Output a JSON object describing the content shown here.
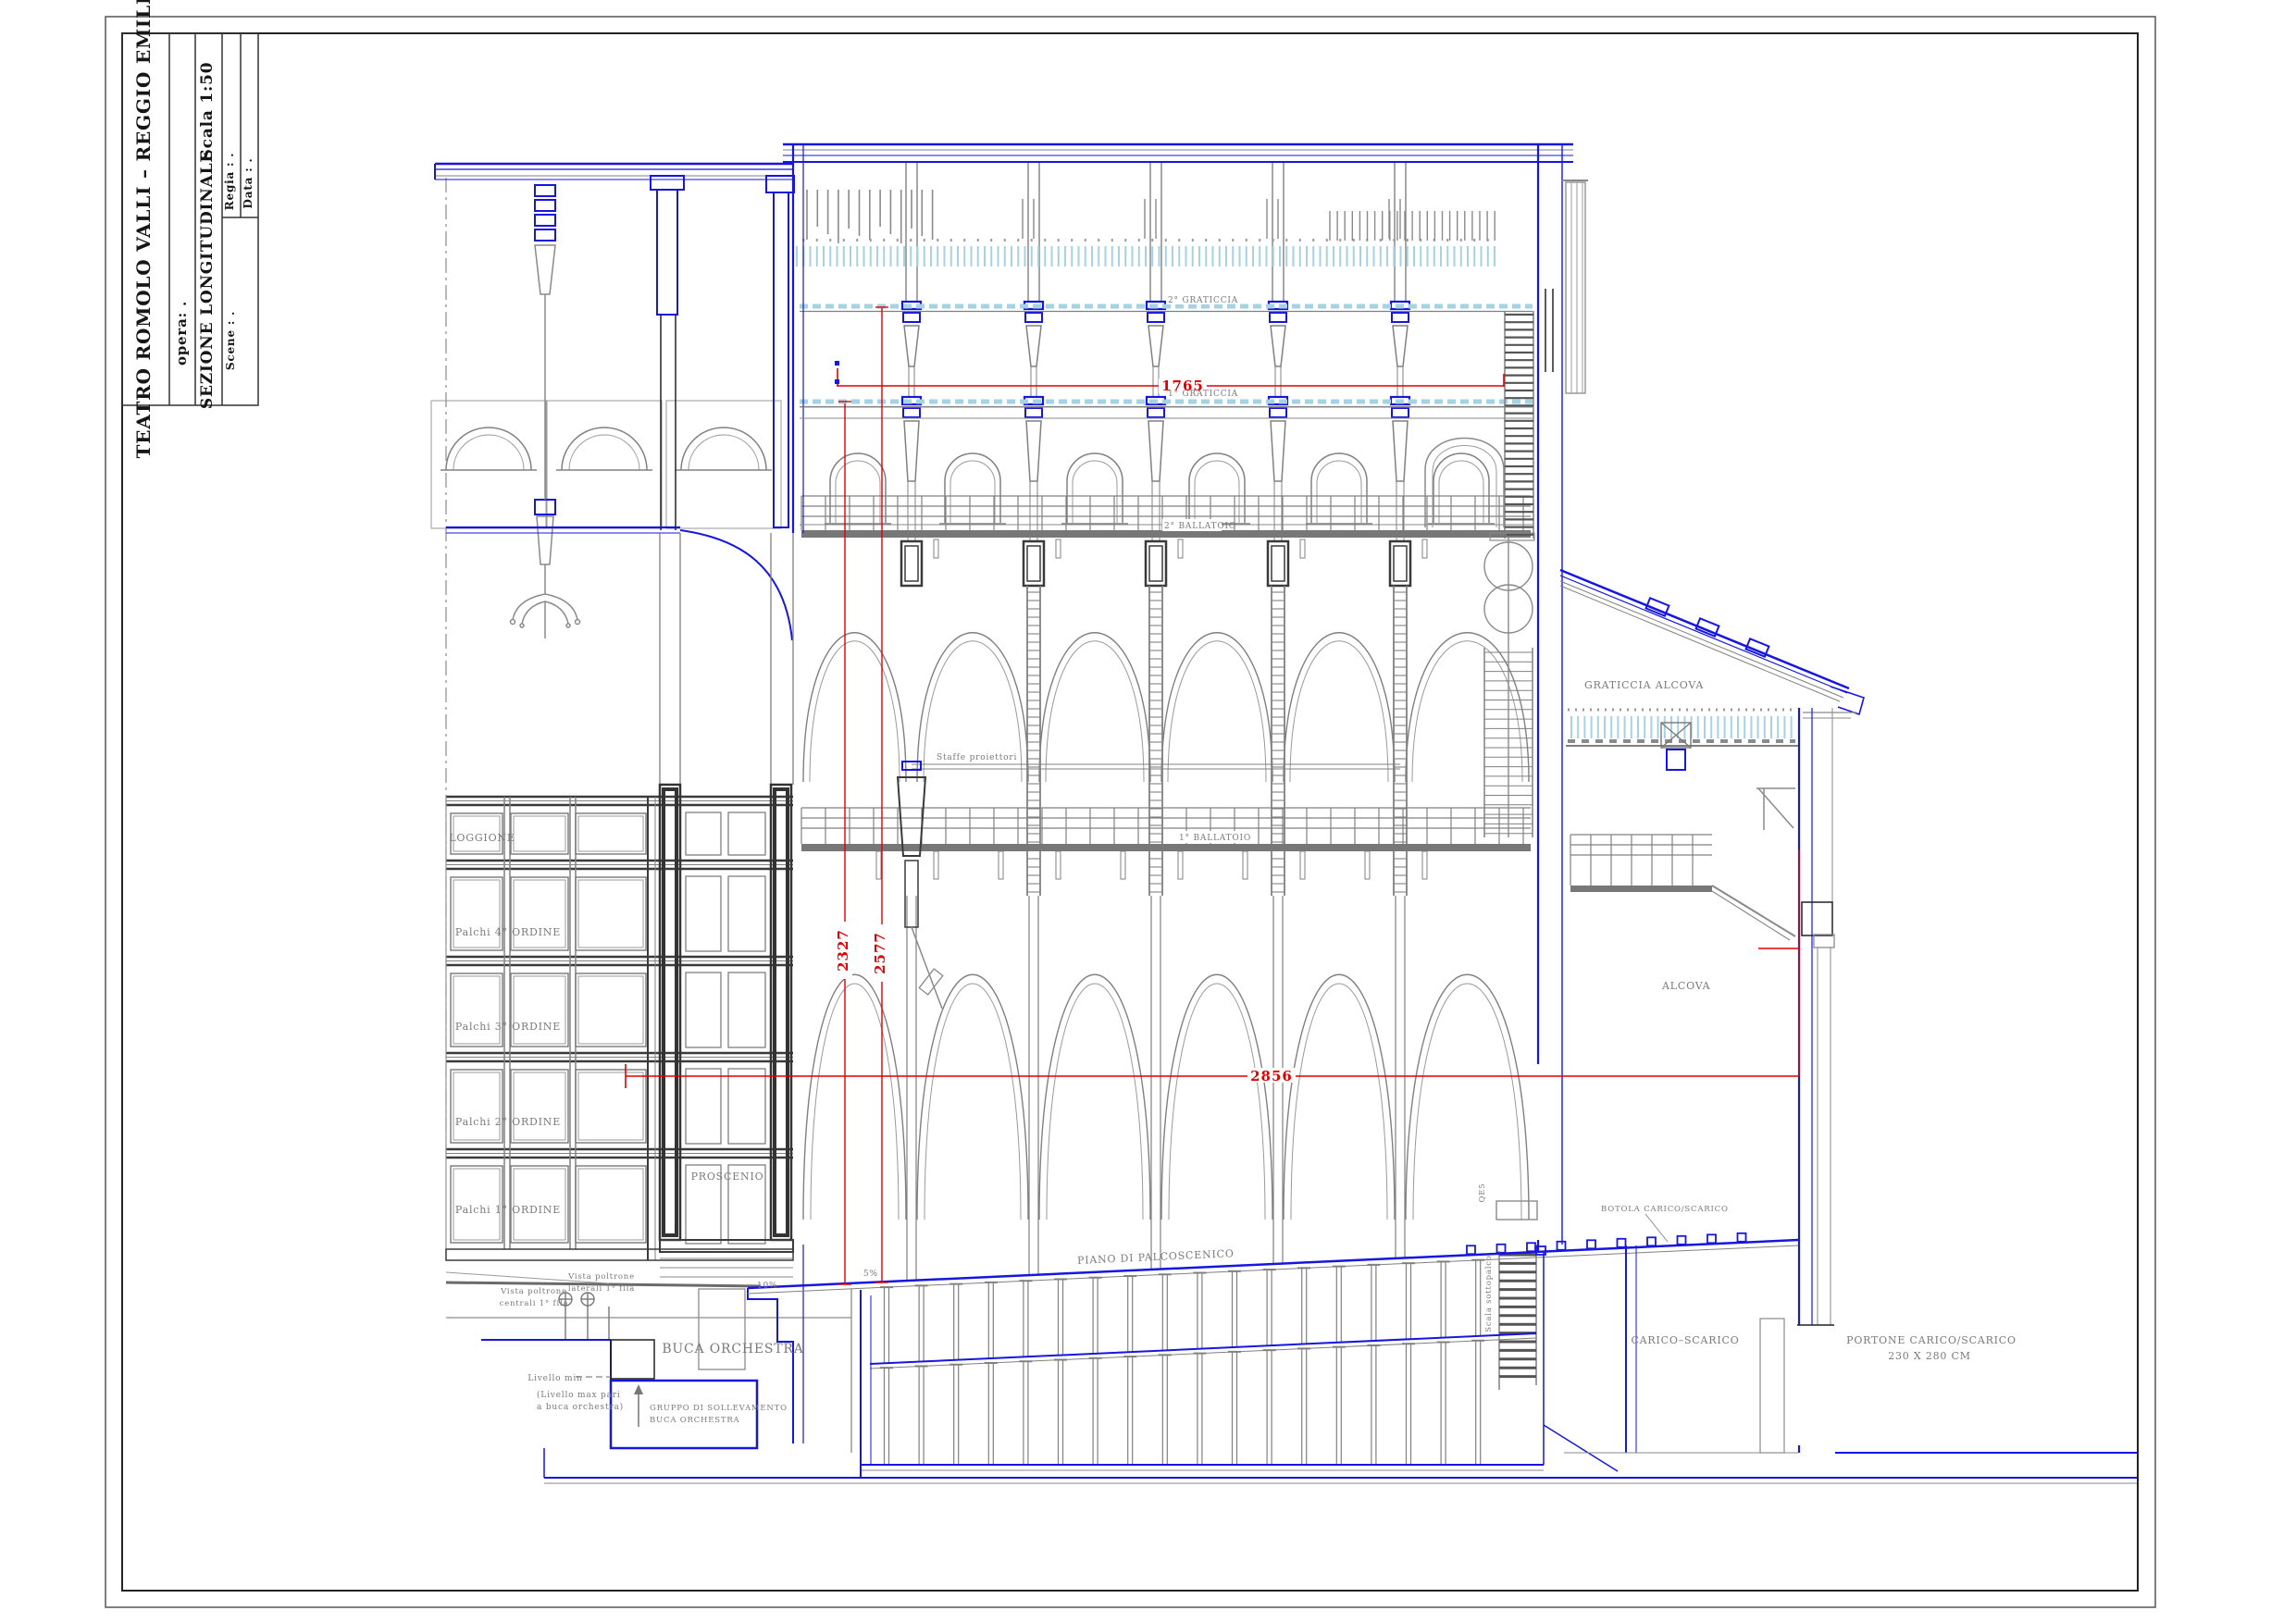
{
  "title_block": {
    "project": "TEATRO  ROMOLO  VALLI  –  REGGIO  EMILIA",
    "opera_label": "opera:   .",
    "drawing_title": "SEZIONE  LONGITUDINALE",
    "scale_label": "Scala  1:50",
    "scene_label": "Scene : .",
    "regia_label": "Regia : .",
    "data_label": "Data : ."
  },
  "labels": {
    "loggione": "LOGGIONE",
    "palchi_4": "Palchi  4°  ORDINE",
    "palchi_3": "Palchi  3°  ORDINE",
    "palchi_2": "Palchi  2°  ORDINE",
    "palchi_1": "Palchi  1°  ORDINE",
    "proscenio": "PROSCENIO",
    "buca_orchestra": "BUCA  ORCHESTRA",
    "piano_palcoscenico": "PIANO  DI  PALCOSCENICO",
    "graticcia_2": "2°  GRATICCIA",
    "graticcia_1": "1°  GRATICCIA",
    "ballatoio_2": "2°  BALLATOIO",
    "ballatoio_1": "1°  BALLATOIO",
    "staffe_proiettori": "Staffe  proiettori",
    "graticcia_alcova": "GRATICCIA  ALCOVA",
    "alcova": "ALCOVA",
    "carico_scarico": "CARICO–SCARICO",
    "portone_1": "PORTONE  CARICO/SCARICO",
    "portone_2": "230  X  280  CM",
    "botola": "BOTOLA  CARICO/SCARICO",
    "scala_sottopalco": "Scala  sottopalco",
    "qe": "QE5",
    "vista_lat_1": "Vista  poltrone",
    "vista_lat_2": "laterali  1°  fila",
    "vista_cen_1": "Vista  poltrone",
    "vista_cen_2": "centrali  1°  fila",
    "livello_min": "Livello  min",
    "livello_max_1": "(Livello  max  pari",
    "livello_max_2": "a  buca  orchestra)",
    "gruppo_1": "GRUPPO  DI  SOLLEVAMENTO",
    "gruppo_2": "BUCA  ORCHESTRA",
    "slope_10": "10%",
    "slope_5": "5%"
  },
  "dimensions": {
    "stage_depth": "1765",
    "height_to_grid_1": "2327",
    "height_to_grid_2": "2577",
    "total_depth": "2856"
  },
  "palette": {
    "line_blue": "#1616e0",
    "line_gray": "#808080",
    "line_dark": "#3a3a3a",
    "dim_red": "#e00000",
    "hatch_cyan": "#a6d2e2",
    "text_gray": "#787878"
  }
}
